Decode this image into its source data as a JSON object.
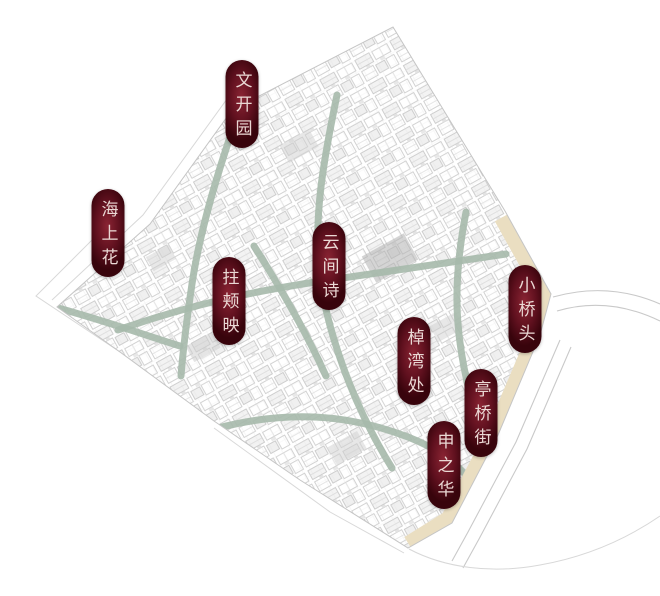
{
  "map": {
    "colors": {
      "label_center": "#8a2433",
      "label_mid": "#5f101e",
      "label_edge": "#38040c",
      "label_text": "#ead8d4",
      "canal": "#a6b9ab",
      "road_tan": "#eadec1",
      "outline_gray": "#c9c9c9",
      "building_line": "#c5c5c5"
    },
    "labels": [
      {
        "text": "文开园",
        "x": 242,
        "y": 104
      },
      {
        "text": "海上花",
        "x": 108,
        "y": 233
      },
      {
        "text": "拄颊映",
        "x": 229,
        "y": 301
      },
      {
        "text": "云间诗",
        "x": 329,
        "y": 266
      },
      {
        "text": "小桥头",
        "x": 525,
        "y": 309
      },
      {
        "text": "棹湾处",
        "x": 414,
        "y": 361
      },
      {
        "text": "亭桥街",
        "x": 481,
        "y": 413
      },
      {
        "text": "申之华",
        "x": 444,
        "y": 465
      }
    ]
  }
}
